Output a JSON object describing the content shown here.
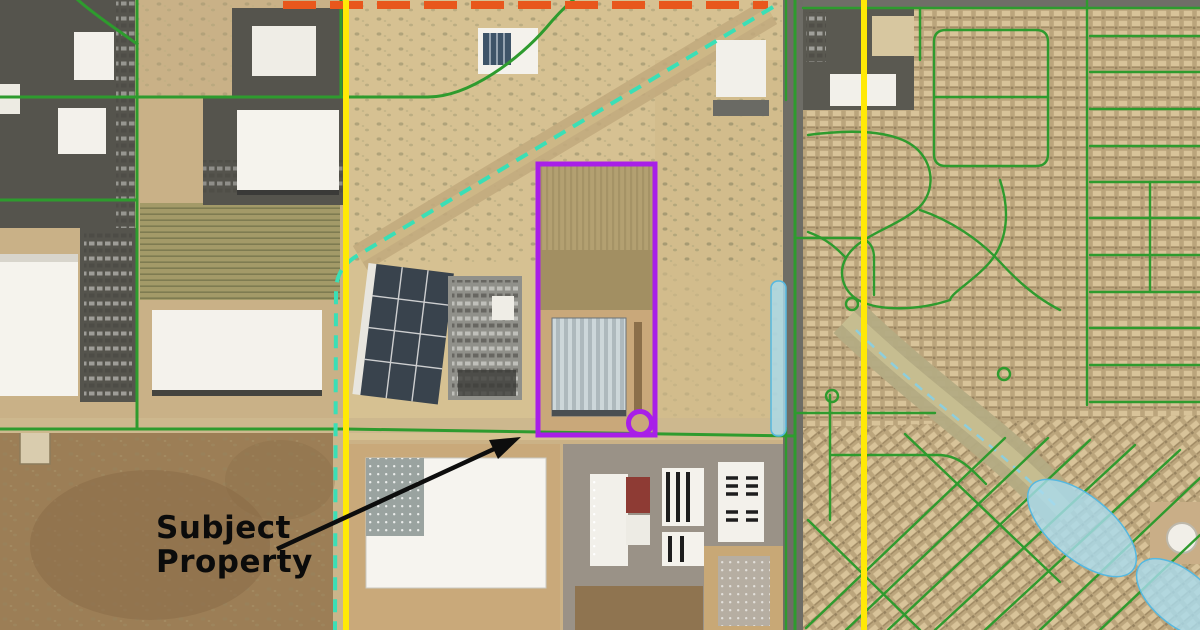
{
  "map": {
    "annotation": {
      "label": "Subject Property"
    },
    "colors": {
      "purple": "#A81FE8",
      "yellow": "#FFE906",
      "teal": "#3ADFB6",
      "orange": "#E8571C",
      "green": "#2E9B2E",
      "water": "#A9DCEF",
      "water_edge": "#55B8E0",
      "arrow": "#0D0D0D"
    }
  }
}
